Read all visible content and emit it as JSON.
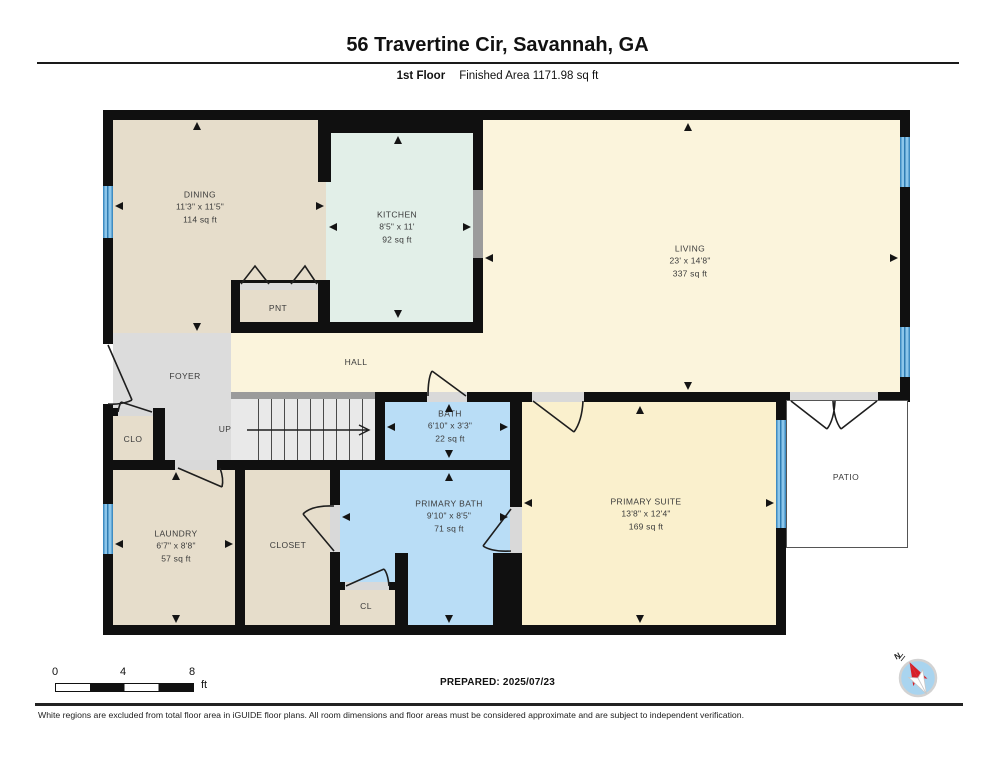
{
  "header": {
    "title": "56 Travertine Cir, Savannah, GA",
    "floor_label": "1st Floor",
    "finished_area": "Finished Area 1171.98 sq ft"
  },
  "rooms": {
    "dining": {
      "name": "DINING",
      "dims": "11'3\" x 11'5\"",
      "area": "114 sq ft"
    },
    "kitchen": {
      "name": "KITCHEN",
      "dims": "8'5\" x 11'",
      "area": "92 sq ft"
    },
    "living": {
      "name": "LIVING",
      "dims": "23' x 14'8\"",
      "area": "337 sq ft"
    },
    "pnt": {
      "name": "PNT"
    },
    "hall": {
      "name": "HALL"
    },
    "foyer": {
      "name": "FOYER"
    },
    "clo": {
      "name": "CLO"
    },
    "up": {
      "name": "UP"
    },
    "bath": {
      "name": "BATH",
      "dims": "6'10\" x 3'3\"",
      "area": "22 sq ft"
    },
    "laundry": {
      "name": "LAUNDRY",
      "dims": "6'7\" x 8'8\"",
      "area": "57 sq ft"
    },
    "closet": {
      "name": "CLOSET"
    },
    "primary_bath": {
      "name": "PRIMARY BATH",
      "dims": "9'10\" x 8'5\"",
      "area": "71 sq ft"
    },
    "cl": {
      "name": "CL"
    },
    "primary_suite": {
      "name": "PRIMARY SUITE",
      "dims": "13'8\" x 12'4\"",
      "area": "169 sq ft"
    },
    "patio": {
      "name": "PATIO"
    }
  },
  "scale": {
    "tick0": "0",
    "tick4": "4",
    "tick8": "8",
    "unit": "ft"
  },
  "prepared": "PREPARED: 2025/07/23",
  "compass": {
    "north_label": "N"
  },
  "footer": "White regions are excluded from total floor area in iGUIDE floor plans. All room dimensions and floor areas must be considered approximate and are subject to independent verification.",
  "colors": {
    "wall": "#101010",
    "tan": "#e6ddcb",
    "mint": "#e2efe8",
    "cream": "#fbf4dc",
    "suite": "#faf0cd",
    "blue": "#b9ddf6",
    "gray": "#dcdcdc",
    "stairs": "#e9e9e9",
    "sill": "#d9d9d9",
    "opening": "#9b9b9b",
    "window": "#5aabde",
    "compass_red": "#d71f27",
    "compass_blue": "#a9d4ef"
  }
}
